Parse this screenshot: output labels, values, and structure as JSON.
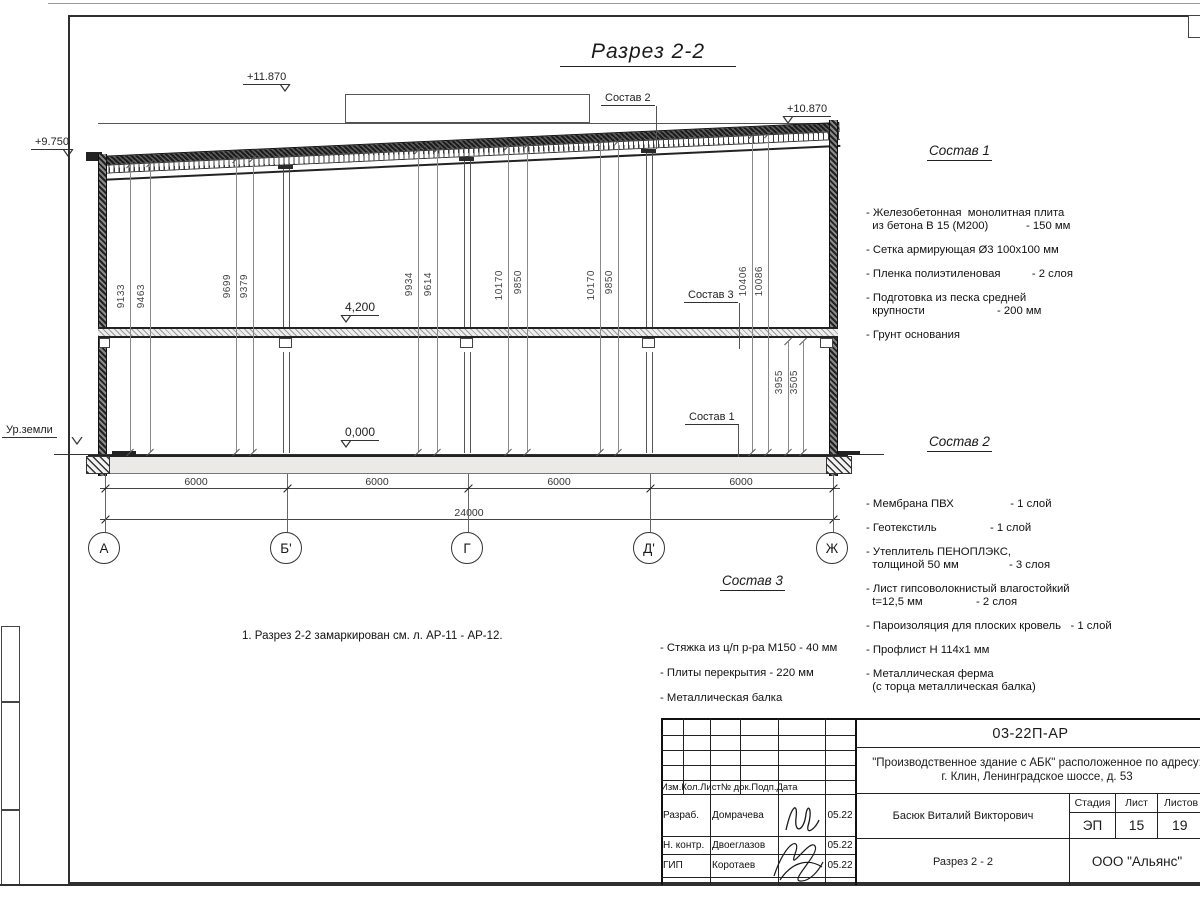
{
  "sheet": {
    "title": "Разрез 2-2",
    "note": "1. Разрез 2-2 замаркирован см. л. АР-11 - АР-12."
  },
  "elevations": {
    "roof_high": "+11.870",
    "roof_right": "+10.870",
    "roof_left": "+9.750",
    "floor2": "4,200",
    "floor0": "0,000",
    "ground": "Ур.земли"
  },
  "callouts": {
    "c2": "Состав 2",
    "c3": "Состав 3",
    "c1": "Состав 1"
  },
  "vdims": [
    {
      "x": 130,
      "top": 165,
      "h": 287,
      "ly": 284,
      "value": "9133"
    },
    {
      "x": 150,
      "top": 164,
      "h": 288,
      "ly": 284,
      "value": "9463"
    },
    {
      "x": 236,
      "top": 160,
      "h": 292,
      "ly": 274,
      "value": "9699"
    },
    {
      "x": 253,
      "top": 159,
      "h": 293,
      "ly": 274,
      "value": "9379"
    },
    {
      "x": 418,
      "top": 151,
      "h": 301,
      "ly": 272,
      "value": "9934"
    },
    {
      "x": 437,
      "top": 150,
      "h": 302,
      "ly": 272,
      "value": "9614"
    },
    {
      "x": 508,
      "top": 147,
      "h": 305,
      "ly": 270,
      "value": "10170"
    },
    {
      "x": 527,
      "top": 146,
      "h": 306,
      "ly": 270,
      "value": "9850"
    },
    {
      "x": 600,
      "top": 143,
      "h": 309,
      "ly": 270,
      "value": "10170"
    },
    {
      "x": 618,
      "top": 142,
      "h": 310,
      "ly": 270,
      "value": "9850"
    },
    {
      "x": 752,
      "top": 136,
      "h": 316,
      "ly": 266,
      "value": "10406"
    },
    {
      "x": 768,
      "top": 135,
      "h": 317,
      "ly": 266,
      "value": "10086"
    },
    {
      "x": 788,
      "top": 342,
      "h": 110,
      "ly": 370,
      "value": "3955"
    },
    {
      "x": 803,
      "top": 342,
      "h": 110,
      "ly": 370,
      "value": "3505"
    }
  ],
  "axes": [
    {
      "x": 105,
      "label": "А"
    },
    {
      "x": 287,
      "label": "Б'"
    },
    {
      "x": 468,
      "label": "Г"
    },
    {
      "x": 650,
      "label": "Д'"
    },
    {
      "x": 833,
      "label": "Ж"
    }
  ],
  "hdims": [
    {
      "x": 196,
      "value": "6000"
    },
    {
      "x": 377,
      "value": "6000"
    },
    {
      "x": 559,
      "value": "6000"
    },
    {
      "x": 741,
      "value": "6000"
    }
  ],
  "hdim_total": "24000",
  "comp1": {
    "heading": "Состав 1",
    "items": [
      "- Железобетонная  монолитная плита\n  из бетона В 15 (М200)            - 150 мм",
      "- Сетка армирующая Ø3 100х100 мм",
      "- Пленка полиэтиленовая          - 2 слоя",
      "- Подготовка из песка средней\n  крупности                       - 200 мм",
      "- Грунт основания"
    ]
  },
  "comp2": {
    "heading": "Состав 2",
    "items": [
      "- Мембрана ПВХ                  - 1 слой",
      "- Геотекстиль                 - 1 слой",
      "- Утеплитель ПЕНОПЛЭКС,\n  толщиной 50 мм                - 3 слоя",
      "- Лист гипсоволокнистый влагостойкий\n  t=12,5 мм                 - 2 слоя",
      "- Пароизоляция для плоских кровель   - 1 слой",
      "- Профлист Н 114х1 мм",
      "- Металлическая ферма\n  (с торца металлическая балка)"
    ]
  },
  "comp3": {
    "heading": "Состав 3",
    "items": [
      "- Стяжка из ц/п р-ра М150 - 40 мм",
      "- Плиты перекрытия - 220 мм",
      "- Металлическая балка"
    ]
  },
  "titleblock": {
    "doc_number": "03-22П-АР",
    "project_line1": "\"Производственное здание с АБК\" расположенное по адресу:",
    "project_line2": "г. Клин, Ленинградское шоссе, д. 53",
    "header_cols": [
      "Изм.",
      "Кол.",
      "Лист",
      "№ док.",
      "Подп.",
      "Дата"
    ],
    "staff": [
      {
        "role": "Разраб.",
        "name": "Домрачева",
        "date": "05.22",
        "top": 794,
        "h": 42
      },
      {
        "role": "Н. контр.",
        "name": "Двоеглазов",
        "date": "05.22",
        "top": 836,
        "h": 18
      },
      {
        "role": "ГИП",
        "name": "Коротаев",
        "date": "05.22",
        "top": 854,
        "h": 23
      }
    ],
    "supervisor": "Басюк Виталий Викторович",
    "stage_label": "Стадия",
    "sheet_label": "Лист",
    "sheets_label": "Листов",
    "stage": "ЭП",
    "sheet_no": "15",
    "sheets_total": "19",
    "drawing_name": "Разрез 2 - 2",
    "company": "ООО \"Альянс\""
  }
}
